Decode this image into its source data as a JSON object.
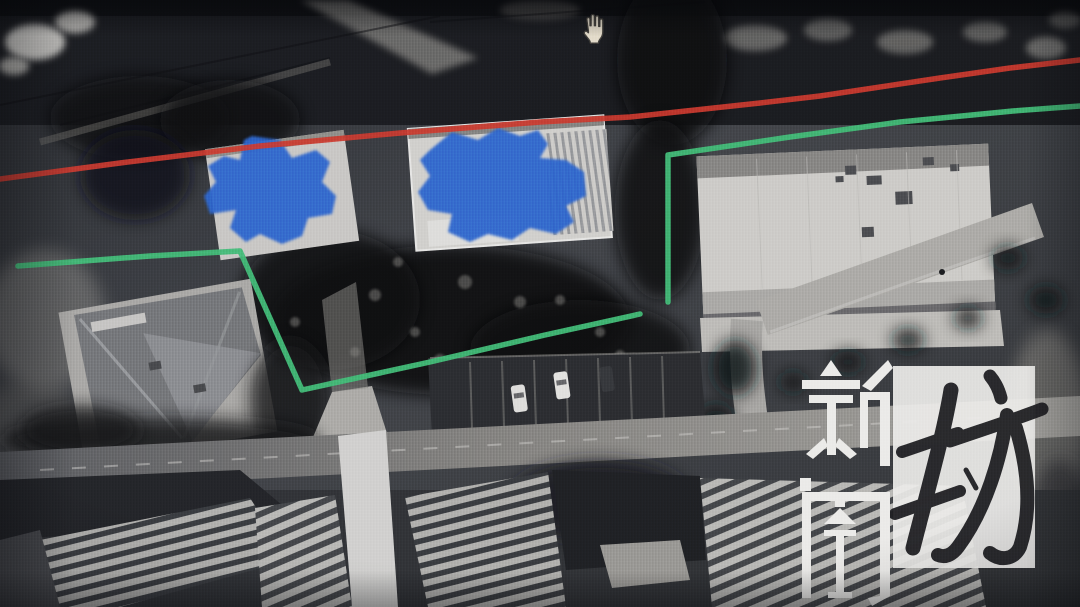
{
  "watermark": {
    "text": "新闻坊",
    "char_1": "新",
    "char_2": "闻",
    "char_3": "坊"
  },
  "cursor": {
    "name": "open-hand-pan-cursor"
  },
  "colors": {
    "annotation_red": "#d63b2e",
    "annotation_green": "#44c47b",
    "tarp_blue": "#2e6ad6",
    "watermark_white": "#f7f6f3",
    "calligraphy_ink": "#1e1e21",
    "cursor_fill": "#efe6d2",
    "cursor_outline": "#43403a"
  }
}
